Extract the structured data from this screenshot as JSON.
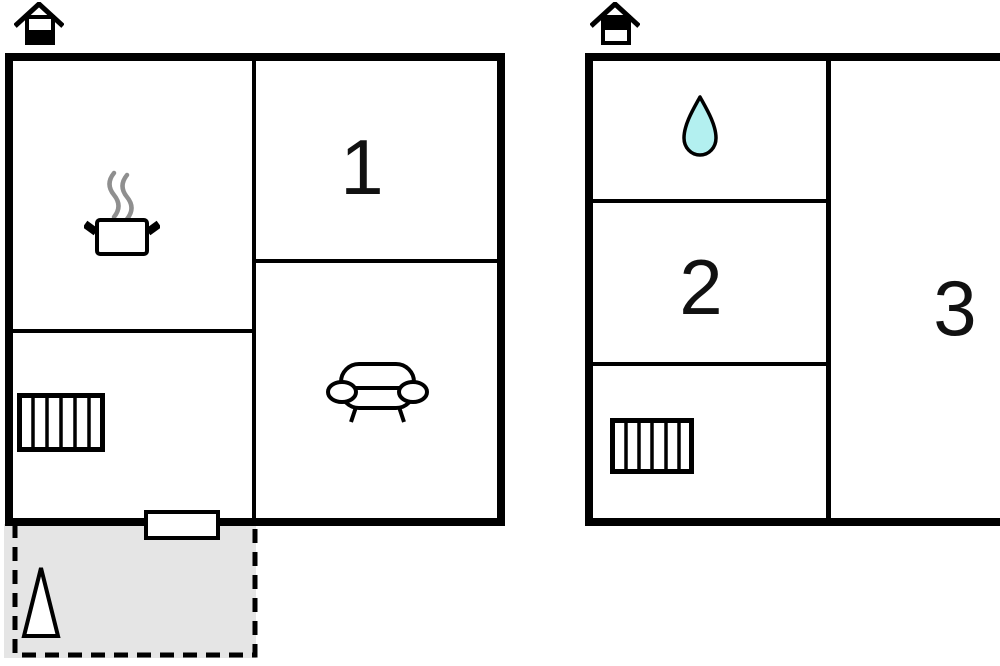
{
  "title": "Two-storey floor plan",
  "colors": {
    "wall": "#000000",
    "background": "#ffffff",
    "terrace_fill": "#e5e5e5",
    "water_drop_fill": "#b3f0f0",
    "steam_gray": "#8f8f8f",
    "label_text": "#111111"
  },
  "plans": [
    {
      "name": "lower-floor-plan",
      "floor_icon": "house-lower-floor-icon",
      "rooms": [
        {
          "label": "1",
          "icon": ""
        },
        {
          "label": "",
          "icon": "cooking-pot-icon"
        },
        {
          "label": "",
          "icon": "sofa-icon"
        },
        {
          "label": "",
          "icon": "stairs-icon"
        }
      ],
      "features": [
        {
          "name": "entrance-door"
        },
        {
          "name": "terrace",
          "icon": "tree-icon"
        }
      ]
    },
    {
      "name": "upper-floor-plan",
      "floor_icon": "house-upper-floor-icon",
      "rooms": [
        {
          "label": "",
          "icon": "water-drop-icon"
        },
        {
          "label": "2",
          "icon": ""
        },
        {
          "label": "",
          "icon": "stairs-icon"
        },
        {
          "label": "3",
          "icon": ""
        }
      ]
    }
  ]
}
